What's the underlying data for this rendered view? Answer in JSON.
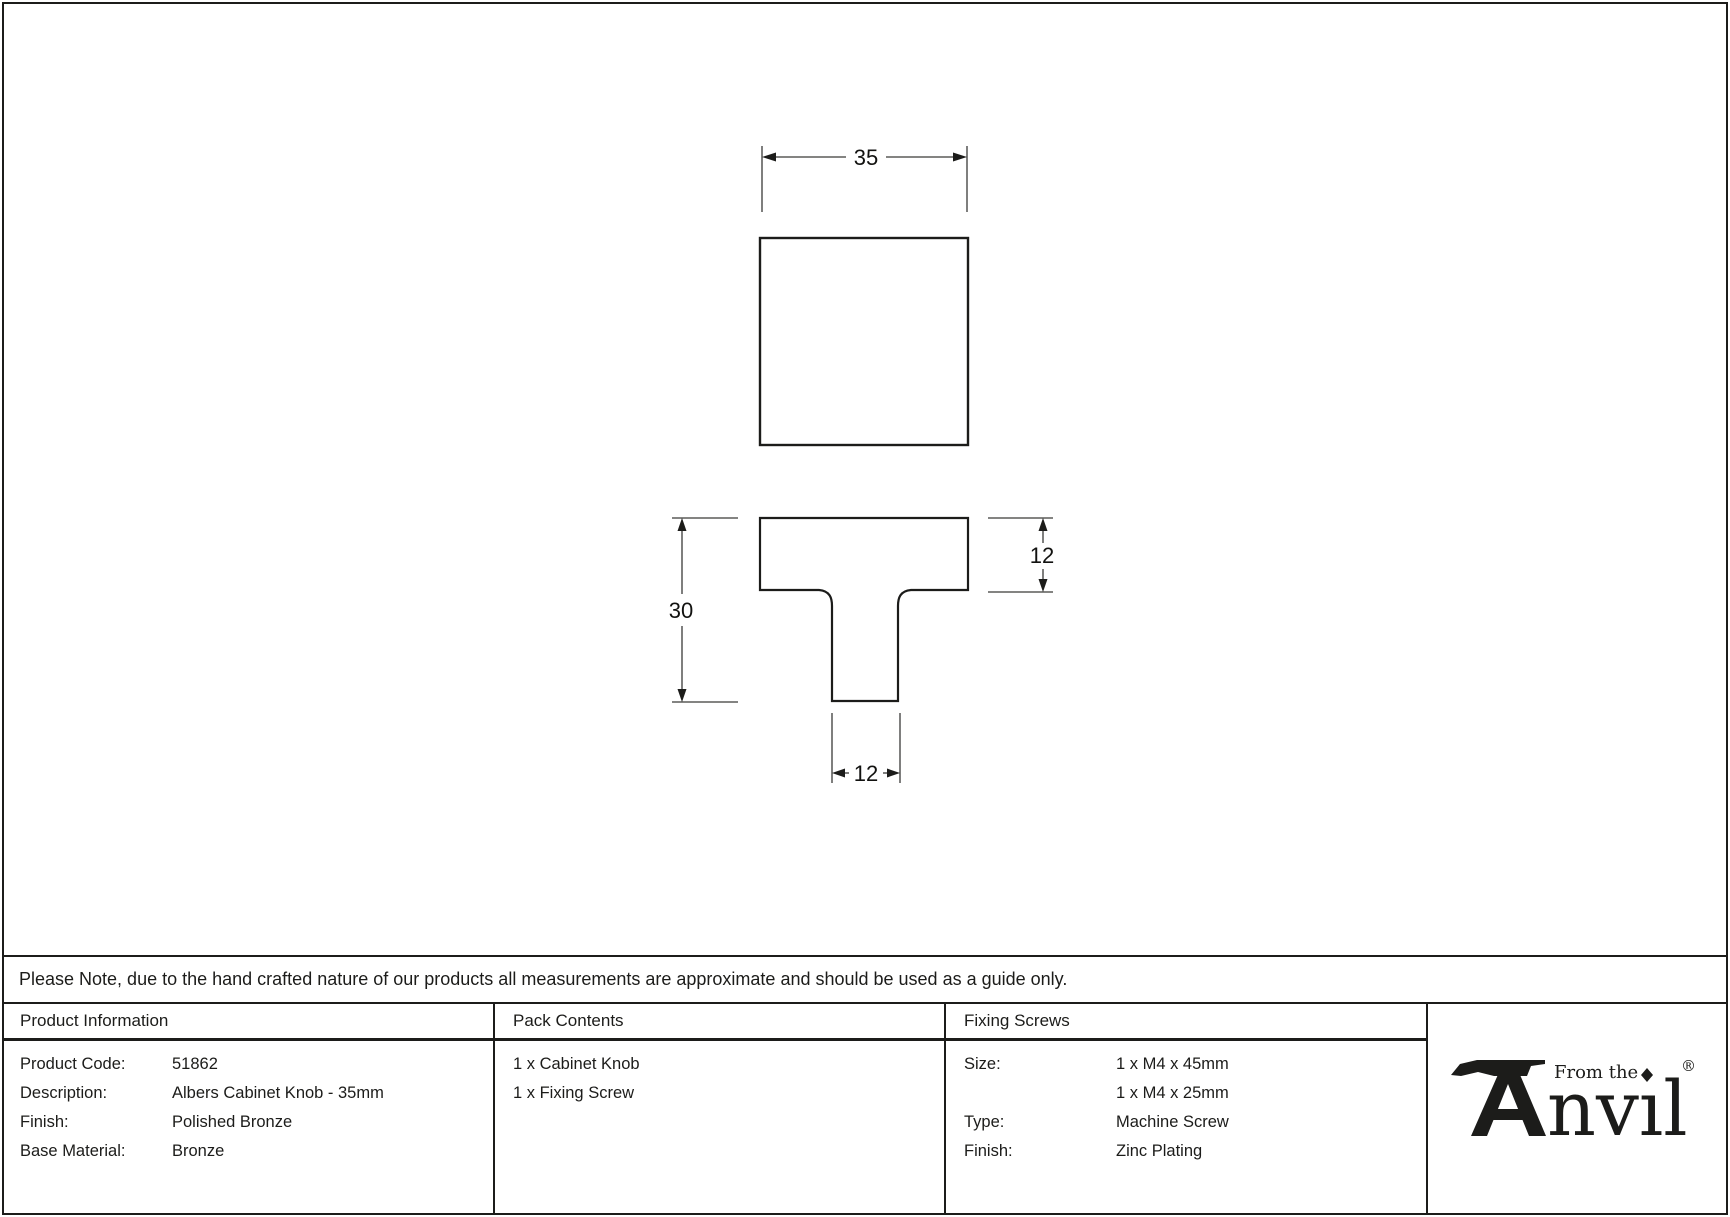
{
  "colors": {
    "ink": "#1c1c1a",
    "line": "#3a3a38",
    "background": "#ffffff"
  },
  "drawing": {
    "front_width_label": "35",
    "overall_height_label": "30",
    "head_depth_label": "12",
    "stem_width_label": "12"
  },
  "note": {
    "text": "Please Note, due to the hand crafted nature of our products all measurements are approximate and should be used as a guide only."
  },
  "table": {
    "product_information": {
      "header": "Product Information",
      "rows": [
        {
          "label": "Product Code:",
          "value": "51862"
        },
        {
          "label": "Description:",
          "value": "Albers Cabinet Knob - 35mm"
        },
        {
          "label": "Finish:",
          "value": "Polished Bronze"
        },
        {
          "label": "Base Material:",
          "value": "Bronze"
        }
      ]
    },
    "pack_contents": {
      "header": "Pack Contents",
      "items": [
        "1 x Cabinet Knob",
        "1 x Fixing Screw"
      ]
    },
    "fixing_screws": {
      "header": "Fixing Screws",
      "rows": [
        {
          "label": "Size:",
          "value": "1 x M4 x 45mm"
        },
        {
          "label": "",
          "value": "1 x M4 x 25mm"
        },
        {
          "label": "Type:",
          "value": "Machine Screw"
        },
        {
          "label": "Finish:",
          "value": "Zinc Plating"
        }
      ]
    }
  },
  "logo": {
    "from_the": "From the",
    "brand_rest": "nvıl",
    "registered": "®"
  }
}
